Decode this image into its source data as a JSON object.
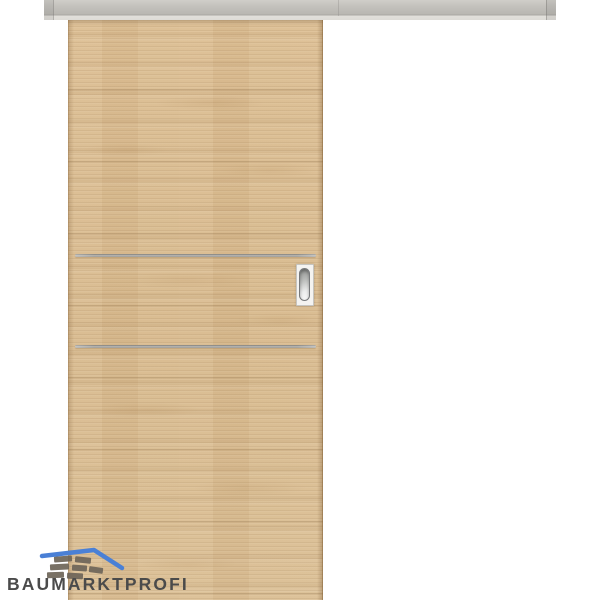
{
  "page": {
    "background": "#ffffff"
  },
  "logo": {
    "brand": "BAUMARKTPROFI",
    "icon": "roof-bricks-icon"
  },
  "colors": {
    "page_bg": "#ffffff",
    "accent_blue": "#4a80d6",
    "brick_gray": "#6e6559",
    "logo_text_gray": "#4b4b4b",
    "rail_gray": "#c4c2bd",
    "rail_lip": "#dedcd7",
    "rail_shadow_line": "#a9a7a2",
    "wood_base": "#dcbe93",
    "wood_dark": "#c3a173",
    "wood_light": "#ead6b2",
    "door_edge": "#b5976a",
    "inlay_metal": "#9a9893",
    "handle_plate": "#f4f3f1",
    "handle_grip_dark": "#8f918f",
    "handle_grip_light": "#fbfbfb"
  }
}
